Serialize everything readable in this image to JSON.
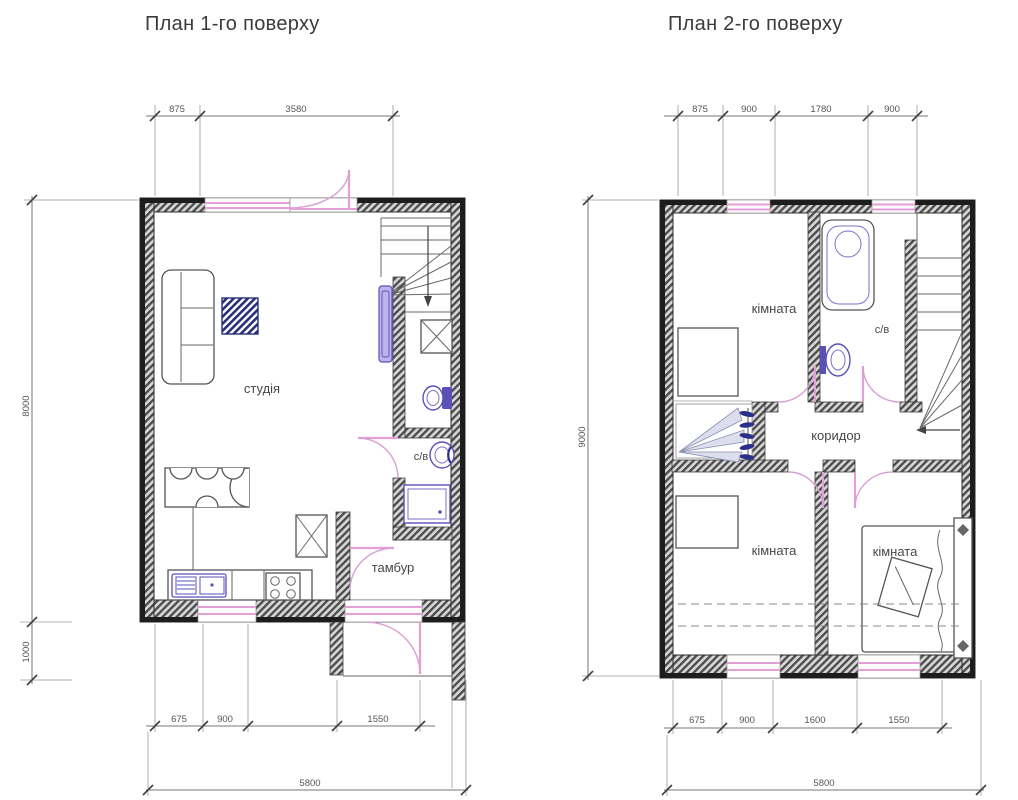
{
  "page": {
    "background": "#ffffff"
  },
  "colors": {
    "wall_dark": "#1d1d1d",
    "wall_hatch": "#4a4a4a",
    "window_pink": "#e39fd7",
    "door_arc_pink": "#db9ed4",
    "fixture_purple": "#5a50b8",
    "furniture_navy": "#2a2f8a",
    "dimension_line": "#777777",
    "text": "#3b3b3b"
  },
  "plans": [
    {
      "title": "План 1-го поверху",
      "rooms": [
        "студія",
        "с/в",
        "тамбур"
      ],
      "dims": {
        "top": [
          "875",
          "3580"
        ],
        "left": [
          "8000",
          "1000"
        ],
        "bottom": [
          "675",
          "900",
          "1550"
        ],
        "total": "5800"
      },
      "fixtures": [
        "sofa",
        "tv-unit",
        "dining-table",
        "chairs",
        "kitchen-counter",
        "kitchen-sink",
        "stove",
        "closet-x",
        "stairs",
        "radiator",
        "toilet",
        "washbasin",
        "shower",
        "entry-door",
        "interior-doors",
        "windows"
      ]
    },
    {
      "title": "План 2-го поверху",
      "rooms": [
        "кімната",
        "с/в",
        "коридор",
        "кімната",
        "кімната"
      ],
      "dims": {
        "top": [
          "875",
          "900",
          "1780",
          "900"
        ],
        "left": [
          "9000"
        ],
        "bottom": [
          "675",
          "900",
          "1600",
          "1550"
        ],
        "total": "5800"
      },
      "fixtures": [
        "bathtub",
        "washbasin",
        "stairs",
        "wardrobe",
        "closet-hangers",
        "bed",
        "pillow",
        "interior-doors",
        "windows",
        "attic-slope-dashes"
      ]
    }
  ]
}
